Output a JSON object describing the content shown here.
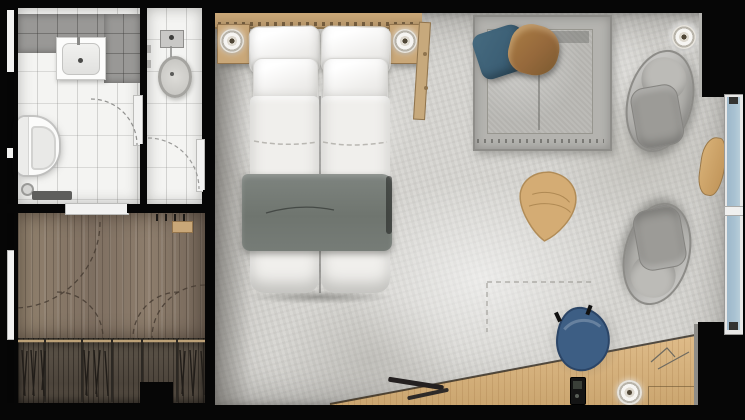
{
  "scene": {
    "kind": "floor-plan",
    "view": "top-down"
  },
  "palette": {
    "bg": "#050505",
    "tile_white": "#f4f4f2",
    "tile_gray": "#999896",
    "wood_floor": "#8c7c6d",
    "wood_closet": "#584f45",
    "wood_desk": "#d9b680",
    "wood_accent": "#c9a778",
    "concrete": "#d7d6d2",
    "bed_white": "#f0efec",
    "blanket_gray": "#6f756f",
    "sofa_gray": "#b4b3af",
    "pillow_blue": "#3c5f75",
    "pillow_brown": "#96693c",
    "chair_blue": "#3d5e84",
    "window_glass": "#a9c2d2",
    "lamp_white": "#f6f5f2"
  },
  "rooms": [
    {
      "name": "bathroom",
      "items": [
        "vanity-sink",
        "faucet",
        "toilet",
        "bath-mat",
        "floor-drain",
        "door-swing"
      ]
    },
    {
      "name": "shower-room",
      "items": [
        "shower-head",
        "shower-basin",
        "wall-controls",
        "door-swing"
      ]
    },
    {
      "name": "entry-hall",
      "items": [
        "entrance-door",
        "coat-hooks",
        "hook-shelf",
        "door-swings",
        "threshold-door"
      ]
    },
    {
      "name": "wardrobe",
      "items": [
        "closet-rod",
        "clothes-hangers",
        "closet-dividers"
      ]
    },
    {
      "name": "bedroom-living",
      "items": [
        "headboard",
        "double-bed",
        "pillows",
        "gray-blanket",
        "nightstand-left",
        "nightstand-right",
        "bedside-lamp-left",
        "bedside-lamp-right",
        "valet-stand",
        "sofa",
        "blue-cushion",
        "leather-cushion",
        "lounge-chair-top",
        "lounge-chair-bottom",
        "floor-lamp",
        "coffee-table",
        "window",
        "window-bench",
        "desk",
        "desk-chair",
        "desk-lamp",
        "phone",
        "drawer",
        "pens",
        "sketch-marks"
      ]
    }
  ]
}
